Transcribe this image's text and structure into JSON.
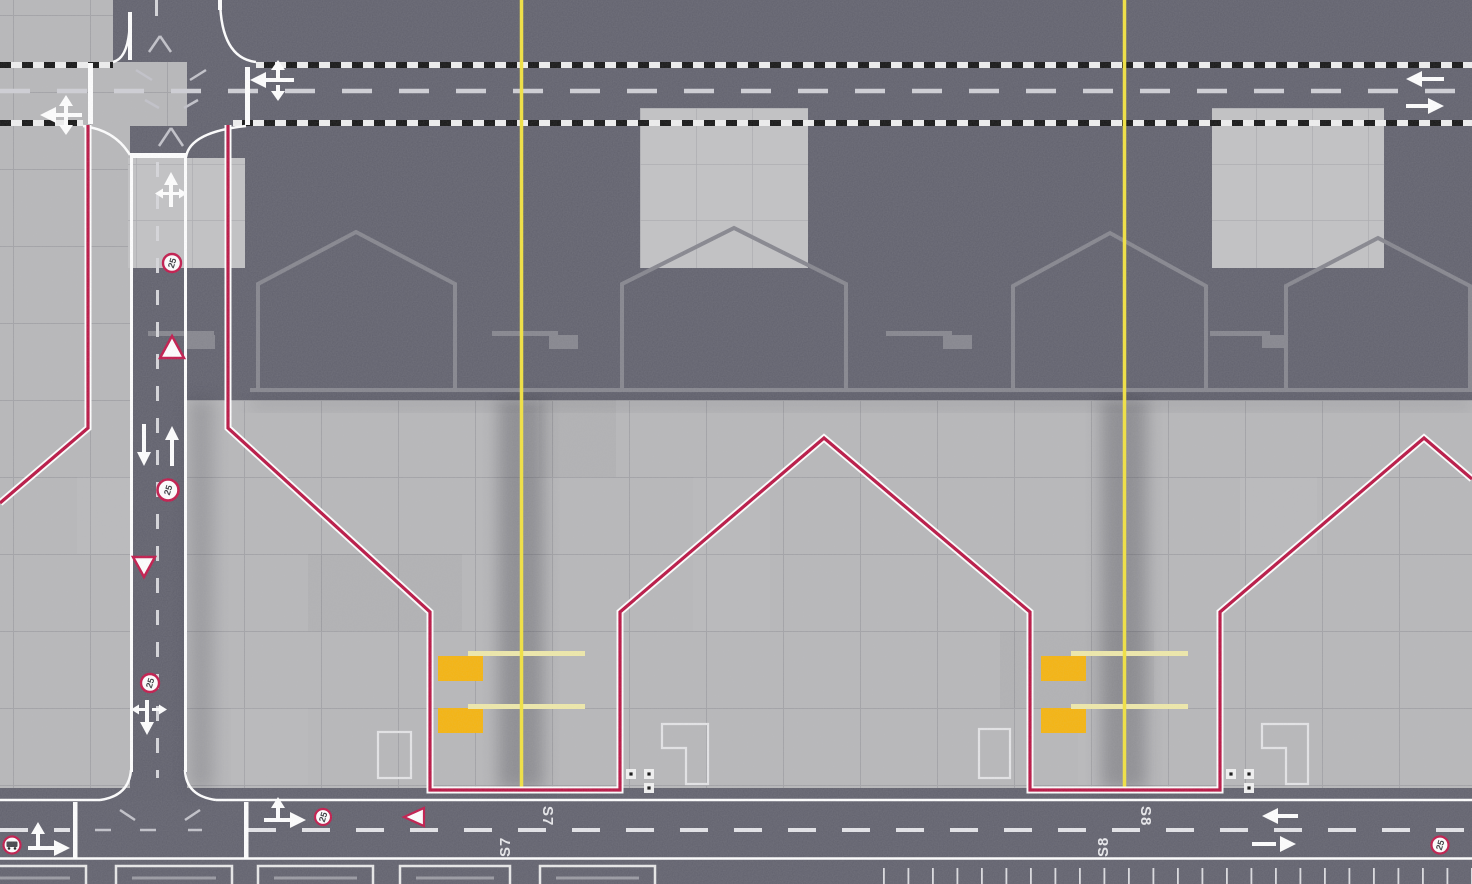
{
  "scene": {
    "description": "Top-down airport ground map with service roads, hangar outlines and two aircraft stands",
    "stands": [
      {
        "id": "S7",
        "label": "S7",
        "boundary_color": "#b91342",
        "centerline_color": "#f2e23e"
      },
      {
        "id": "S8",
        "label": "S8",
        "boundary_color": "#b91342",
        "centerline_color": "#f2e23e"
      }
    ],
    "road_markings": {
      "speed_limit": "25",
      "stand_label_left": "S7",
      "stand_label_right": "S8"
    },
    "colors": {
      "asphalt": "#61616d",
      "concrete": "#b7b7b9",
      "concrete_pad": "#c2c2c4",
      "boundary_red": "#b91342",
      "taxi_yellow": "#f2e23e",
      "stand_bar_yellow": "#efe9a9",
      "stop_block_orange": "#f6b40d",
      "marking_white": "#ffffff",
      "outline_gray": "#85858d"
    }
  }
}
